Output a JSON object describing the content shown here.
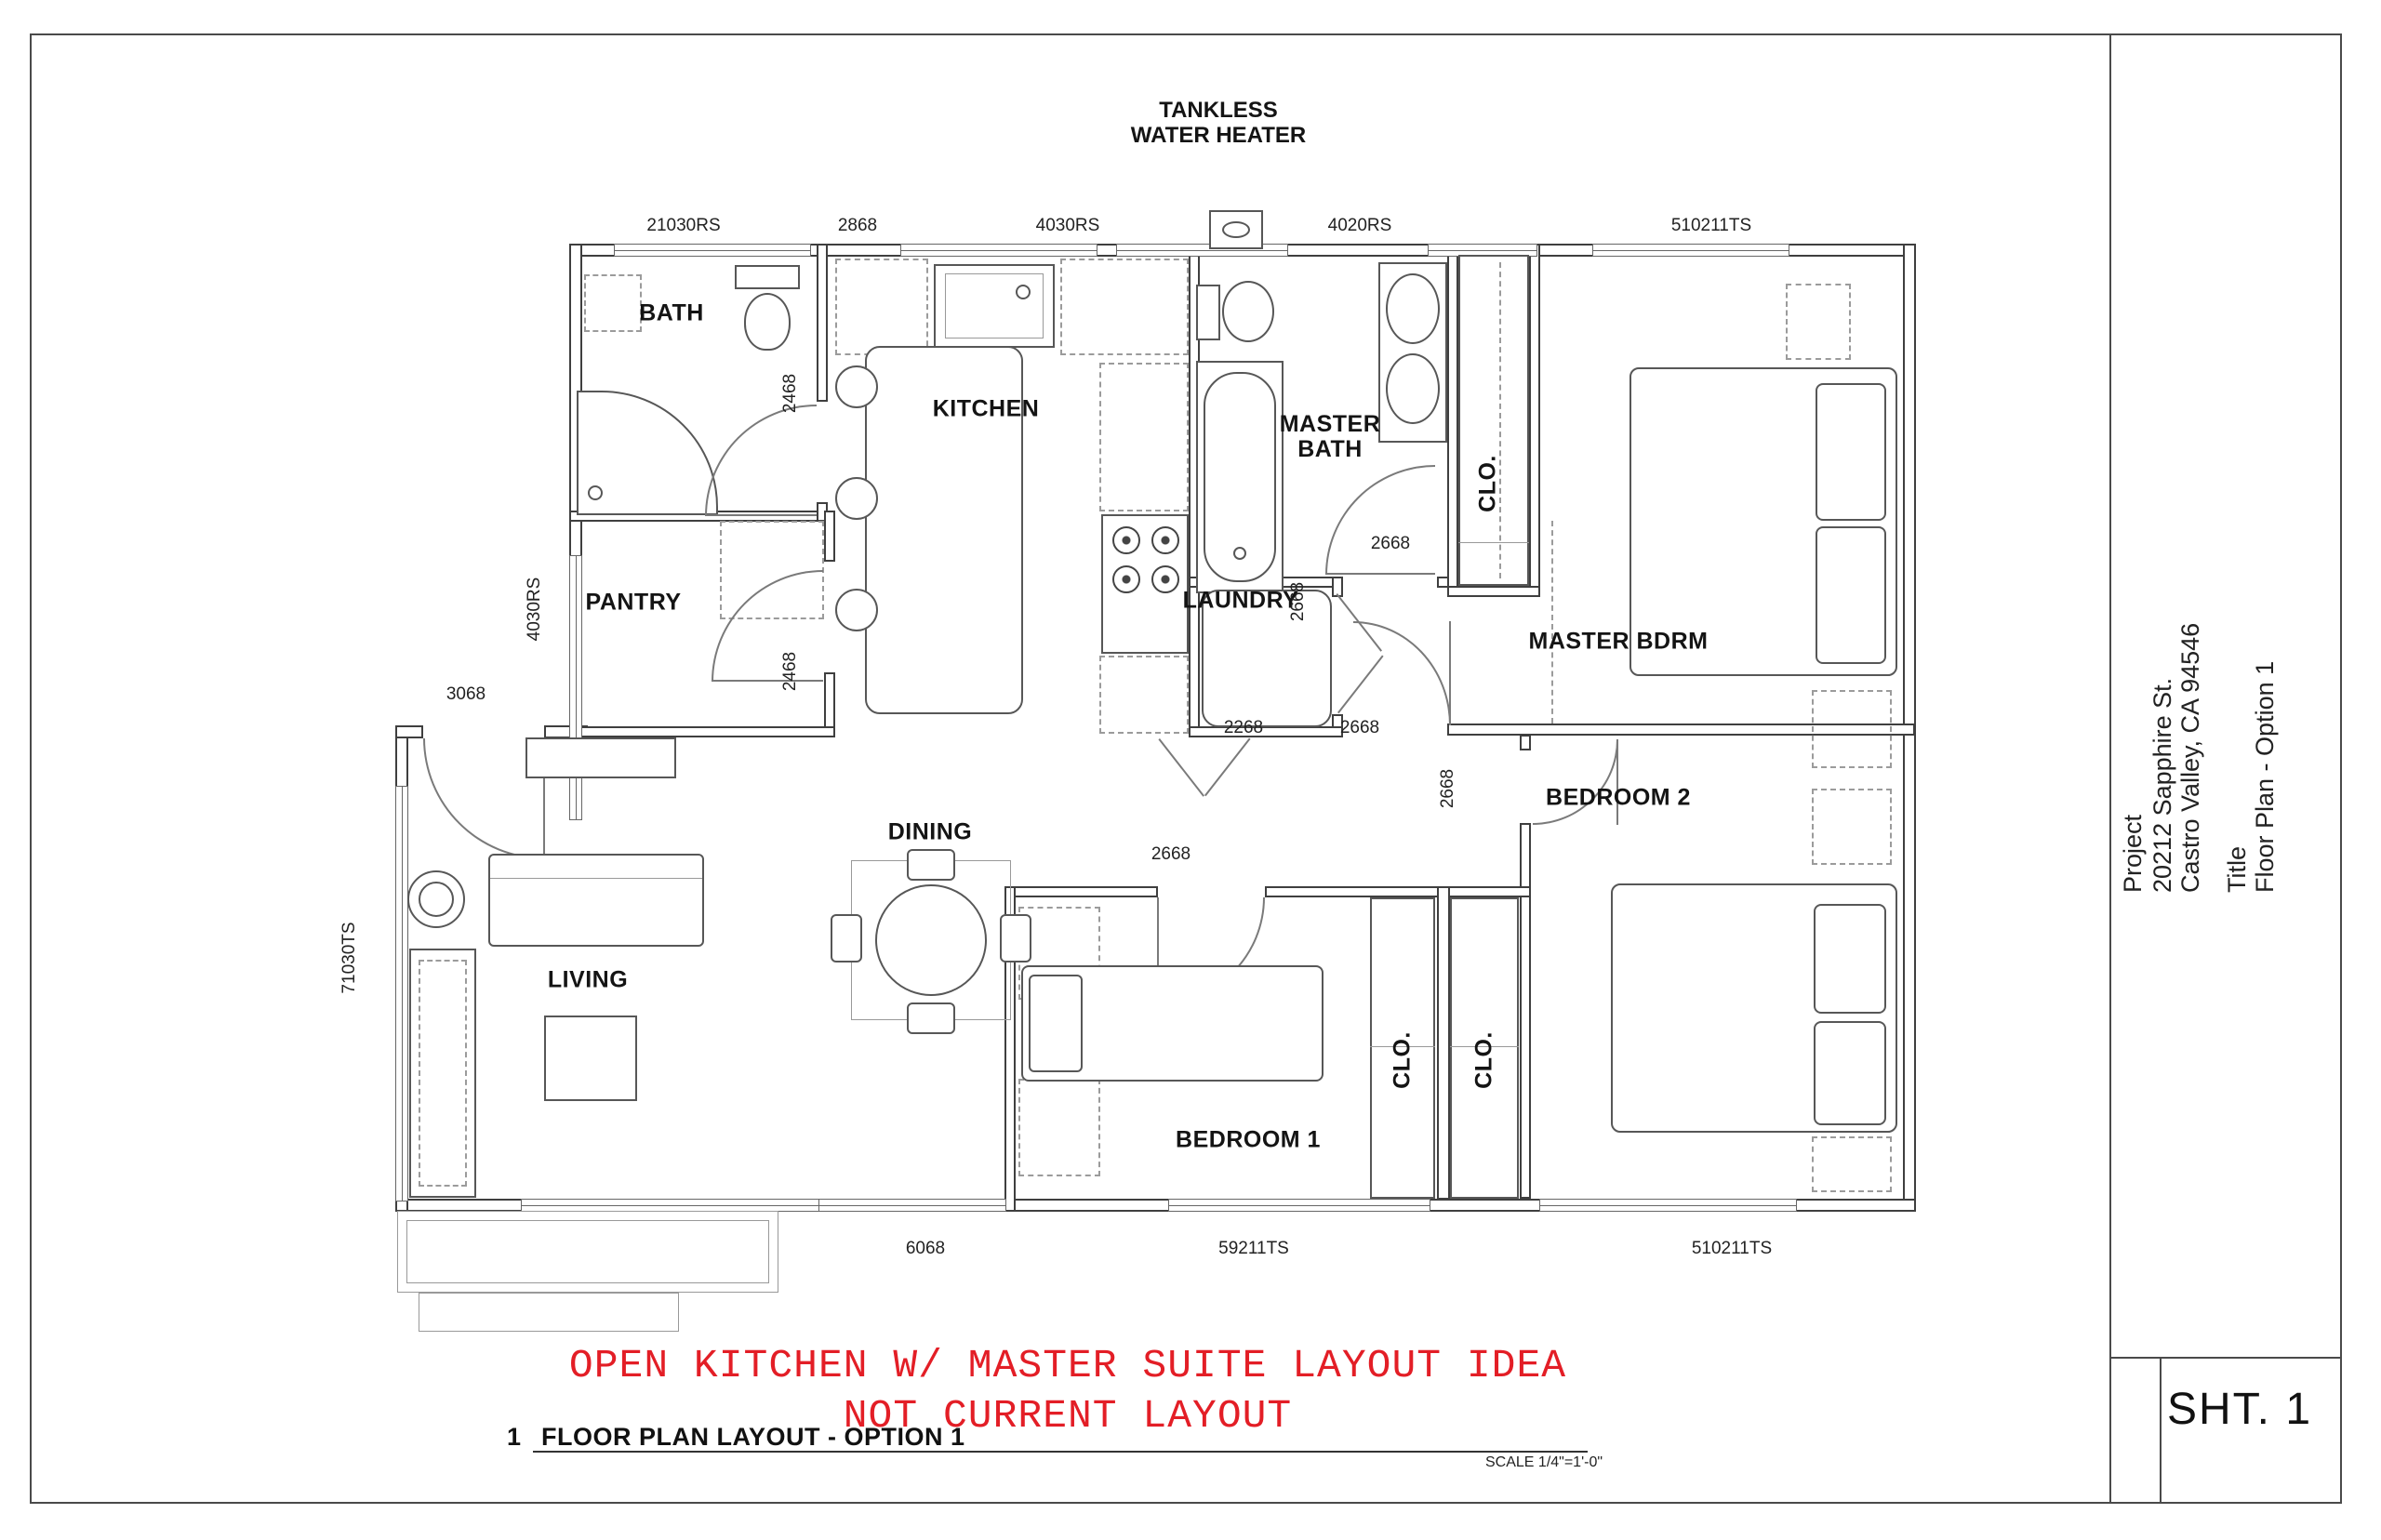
{
  "colors": {
    "note_red": "#e31e26",
    "line": "#3f3f3f"
  },
  "title_block": {
    "project_label": "Project",
    "address_line1": "20212 Sapphire St.",
    "address_line2": "Castro Valley, CA 94546",
    "title_label": "Title",
    "title_value": "Floor Plan - Option 1",
    "sheet_number": "SHT. 1"
  },
  "plan": {
    "tankless": "TANKLESS WATER HEATER",
    "rooms": {
      "bath": "BATH",
      "kitchen": "KITCHEN",
      "master_bath": "MASTER BATH",
      "clo_master": "CLO.",
      "master_bdrm": "MASTER BDRM",
      "pantry": "PANTRY",
      "laundry": "LAUNDRY",
      "bedroom2": "BEDROOM 2",
      "dining": "DINING",
      "living": "LIVING",
      "bedroom1": "BEDROOM 1",
      "clo_1": "CLO.",
      "clo_2": "CLO."
    },
    "dims": {
      "d_21030rs": "21030RS",
      "d_2868": "2868",
      "d_4030rs_top": "4030RS",
      "d_4020rs": "4020RS",
      "d_510211ts_top": "510211TS",
      "d_2468_bath": "2468",
      "d_2468_pantry": "2468",
      "d_4030rs_left": "4030RS",
      "d_3068": "3068",
      "d_71030ts": "71030TS",
      "d_2668_mbath": "2668",
      "d_2668_laundry": "2668",
      "d_2268": "2268",
      "d_2668_hall": "2668",
      "d_2668_b2door": "2668",
      "d_2668_b1": "2668",
      "d_6068": "6068",
      "d_59211ts": "59211TS",
      "d_510211ts_bot": "510211TS"
    }
  },
  "notes": {
    "line1": "OPEN KITCHEN W/ MASTER SUITE LAYOUT IDEA",
    "line2": "NOT CURRENT LAYOUT"
  },
  "caption": {
    "number": "1",
    "title": "FLOOR PLAN LAYOUT - OPTION 1",
    "scale": "SCALE 1/4\"=1'-0\""
  }
}
